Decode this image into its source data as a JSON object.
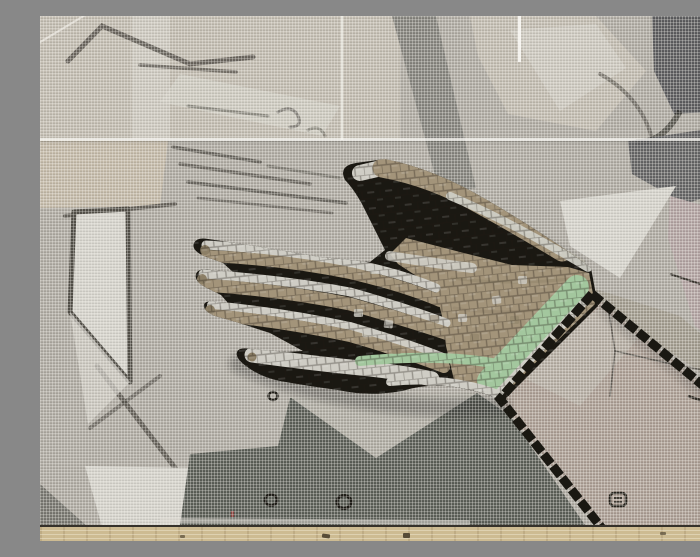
{
  "image": {
    "title": "Mosaic hand in progress",
    "description": "Close-up photograph of an unfinished mosaic mural: an open hand tiled in tan, silver and mint-green tesserae with a black tile outline, laid over a grey working cartoon that is covered by fibreglass mesh. A black-bordered cuff panel at the lower right is still untiled, small circular registration marks and a stamped mark are drawn on the cartoon, and a wooden batten runs along the bottom edge.",
    "medium": "photograph",
    "subject": "mosaic hand with cuff panel on mesh-covered cartoon"
  },
  "palette": {
    "base": "#aeaaa2",
    "beige": "#c1bbb0",
    "beigeWarm": "#c3b9a8",
    "lightGrey": "#d5d3cc",
    "greyBand": "#85847e",
    "darkGrey": "#5c5c5e",
    "pink": "#b2a3a2",
    "olive": "#9d9789",
    "darkRegion": "#5b5e57",
    "midGrey": "#aeaba2",
    "darkTri": "#787770",
    "sketch": "#524f48",
    "outline": "#1a1812",
    "tileTan": "#a3947a",
    "tileTanDeep": "#8c7f66",
    "tileSilver": "#cfcdc5",
    "tileGreen": "#a3c79e",
    "cuffBg": "#ab9e94",
    "cuffLight": "#b5aea4",
    "wood": "#cdbb92",
    "woodDark": "#574c38",
    "redFleck": "#8a4440",
    "meshWhite": "#f4f2ec"
  },
  "regions": {
    "hand": "tiled open hand: tan rows, silver highlight rows, mint-green wrist band, black tesserae outline",
    "cuff": "untiled cuff panel outlined with black tesserae",
    "background": "grey cartoon with charcoal sketch lines and abstract shapes",
    "mesh": "fibreglass mesh with bright overlap seams",
    "wood": "wooden frame batten along bottom edge"
  },
  "marks": {
    "circle_left": "small circular registration mark",
    "circle_right": "circular registration mark",
    "circle_upper": "small circular registration mark",
    "stamp": "stamped square mark inside cuff panel",
    "red_fleck": "small red paint fleck"
  }
}
